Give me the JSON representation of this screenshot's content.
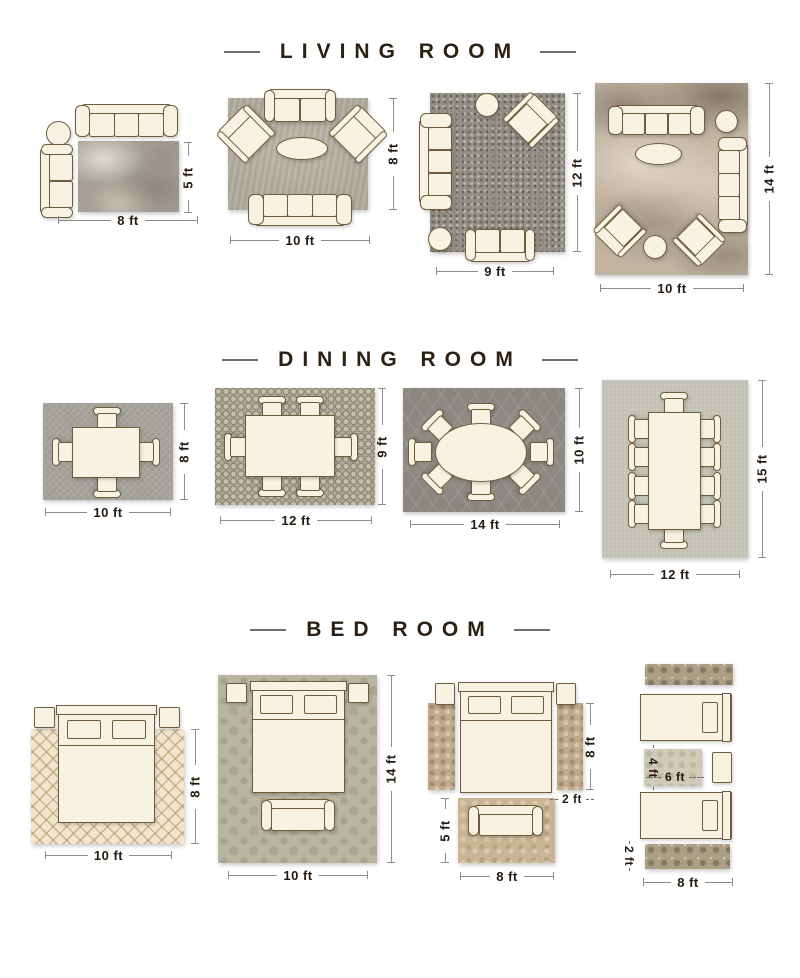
{
  "colors": {
    "background": "#ffffff",
    "title_text": "#2c2013",
    "dimension_text": "#241a10",
    "dimension_line": "#8d8d8d",
    "furniture_fill": "#f8f2e2",
    "furniture_outline": "#6e5c3c"
  },
  "sections": [
    {
      "title": "LIVING ROOM",
      "layouts": [
        {
          "name": "living-room-8x5",
          "width_label": "8 ft",
          "height_label": "5 ft",
          "rug_style": "gray-marble",
          "furniture": [
            "three-seat-sofa",
            "round-side-table",
            "two-seat-loveseat"
          ]
        },
        {
          "name": "living-room-10x8",
          "width_label": "10 ft",
          "height_label": "8 ft",
          "rug_style": "warm-gray",
          "furniture": [
            "two-seat-loveseat",
            "armchair",
            "armchair",
            "oval-coffee-table",
            "three-seat-sofa"
          ]
        },
        {
          "name": "living-room-9x12",
          "width_label": "9 ft",
          "height_label": "12 ft",
          "rug_style": "dark-speckle",
          "furniture": [
            "round-side-table",
            "armchair",
            "three-seat-sofa",
            "round-ottoman",
            "two-seat-loveseat"
          ]
        },
        {
          "name": "living-room-10x14",
          "width_label": "10 ft",
          "height_label": "14 ft",
          "rug_style": "abstract-beige",
          "furniture": [
            "three-seat-sofa",
            "round-side-table",
            "oval-coffee-table",
            "three-seat-sofa",
            "armchair",
            "armchair",
            "round-ottoman"
          ]
        }
      ]
    },
    {
      "title": "DINING ROOM",
      "layouts": [
        {
          "name": "dining-room-10x8",
          "width_label": "10 ft",
          "height_label": "8 ft",
          "rug_style": "plain-gray",
          "furniture": [
            "rectangular-table",
            "4-chairs"
          ]
        },
        {
          "name": "dining-room-12x9",
          "width_label": "12 ft",
          "height_label": "9 ft",
          "rug_style": "mosaic",
          "furniture": [
            "rectangular-table",
            "6-chairs"
          ]
        },
        {
          "name": "dining-room-14x10",
          "width_label": "14 ft",
          "height_label": "10 ft",
          "rug_style": "dark-trellis",
          "furniture": [
            "oval-table",
            "8-chairs"
          ]
        },
        {
          "name": "dining-room-12x15",
          "width_label": "12 ft",
          "height_label": "15 ft",
          "rug_style": "light-sage",
          "furniture": [
            "rectangular-table",
            "10-chairs"
          ]
        }
      ]
    },
    {
      "title": "BED ROOM",
      "layouts": [
        {
          "name": "bed-room-10x8",
          "width_label": "10 ft",
          "height_label": "8 ft",
          "rug_style": "cream-diamond",
          "furniture": [
            "double-bed",
            "nightstand",
            "nightstand"
          ]
        },
        {
          "name": "bed-room-10x14",
          "width_label": "10 ft",
          "height_label": "14 ft",
          "rug_style": "sage-damask",
          "furniture": [
            "double-bed",
            "nightstand",
            "nightstand",
            "bench"
          ]
        },
        {
          "name": "bed-room-side-runners",
          "bed_height_label": "8 ft",
          "runner_width_label": "2 ft",
          "foot_rug_height_label": "5 ft",
          "foot_rug_width_label": "8 ft",
          "rug_style": "tan-floral",
          "furniture": [
            "double-bed",
            "nightstand",
            "nightstand",
            "side-runner",
            "side-runner",
            "foot-rug",
            "bench"
          ]
        },
        {
          "name": "bed-room-twin-beds",
          "small_rug_height_label": "4 ft",
          "small_rug_width_label": "6 ft",
          "runner_height_label": "2 ft",
          "runner_width_label": "8 ft",
          "rug_style": "ornate-runner",
          "furniture": [
            "twin-bed",
            "twin-bed",
            "nightstand",
            "runner",
            "runner",
            "center-rug"
          ]
        }
      ]
    }
  ]
}
